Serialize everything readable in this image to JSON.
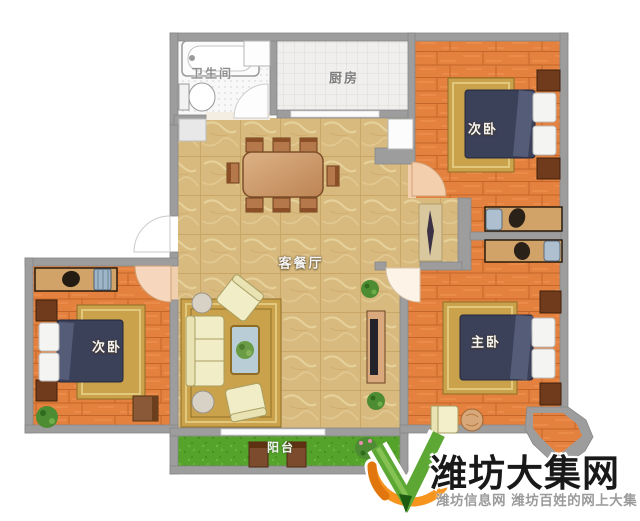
{
  "plan": {
    "rooms": [
      {
        "id": "bathroom",
        "label": "卫生间"
      },
      {
        "id": "kitchen",
        "label": "厨房"
      },
      {
        "id": "bedroom-top-right",
        "label": "次卧"
      },
      {
        "id": "living-dining",
        "label": "客餐厅"
      },
      {
        "id": "bedroom-left",
        "label": "次卧"
      },
      {
        "id": "master-bedroom",
        "label": "主卧"
      },
      {
        "id": "balcony",
        "label": "阳台"
      }
    ]
  },
  "watermark": {
    "site_name": "潍坊大集网",
    "tagline": "潍坊信息网 潍坊百姓的网上大集"
  },
  "palette": {
    "wall": "#9d9d9d",
    "marble_floor": "#d8ba7e",
    "wood_floor": "#e5813e",
    "kitchen_tile": "#f0efed",
    "bathroom_tile": "#f8f8f8",
    "balcony_grass": "#55a32b",
    "bed": "#3c415a",
    "rug_gold": "#c9a24b",
    "sofa_cream": "#f1edc6",
    "logo_green": "#5da834",
    "logo_orange": "#f7941e",
    "title_color": "#191919",
    "tagline_color": "#9b9b9b"
  }
}
